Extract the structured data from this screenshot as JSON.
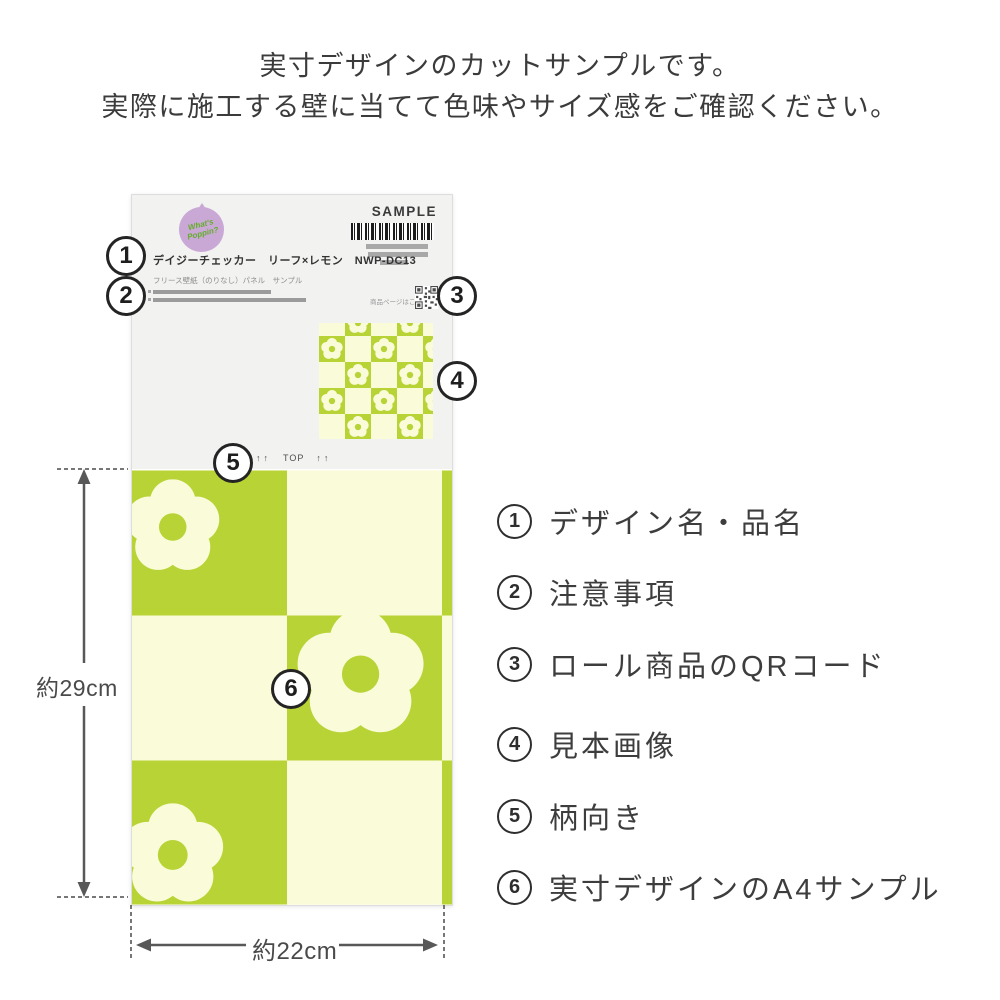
{
  "intro": {
    "line1": "実寸デザインのカットサンプルです。",
    "line2": "実際に施工する壁に当てて色味やサイズ感をご確認ください。"
  },
  "palette": {
    "green": "#b8d335",
    "cream": "#fafbd9",
    "label_bg": "#f2f2f1",
    "badge_purple": "#c9a8d6",
    "badge_green": "#64ad29",
    "bar_gray": "#a8a8a8"
  },
  "sheet": {
    "brand": "What's Poppin?",
    "sample_label": "SAMPLE",
    "product_name": "デイジーチェッカー　リーフ×レモン　NWP-DC13",
    "product_subtitle": "フリース壁紙（のりなし）パネル　サンプル",
    "qr_caption": "商品ページはこちら",
    "top_arrows": "↑↑",
    "top_label": "TOP"
  },
  "callouts": [
    "1",
    "2",
    "3",
    "4",
    "5",
    "6"
  ],
  "dimensions": {
    "height": "約29cm",
    "width": "約22cm"
  },
  "legend": [
    {
      "num": "1",
      "label": "デザイン名・品名"
    },
    {
      "num": "2",
      "label": "注意事項"
    },
    {
      "num": "3",
      "label": "ロール商品のQRコード"
    },
    {
      "num": "4",
      "label": "見本画像"
    },
    {
      "num": "5",
      "label": "柄向き"
    },
    {
      "num": "6",
      "label": "実寸デザインのA4サンプル"
    }
  ]
}
